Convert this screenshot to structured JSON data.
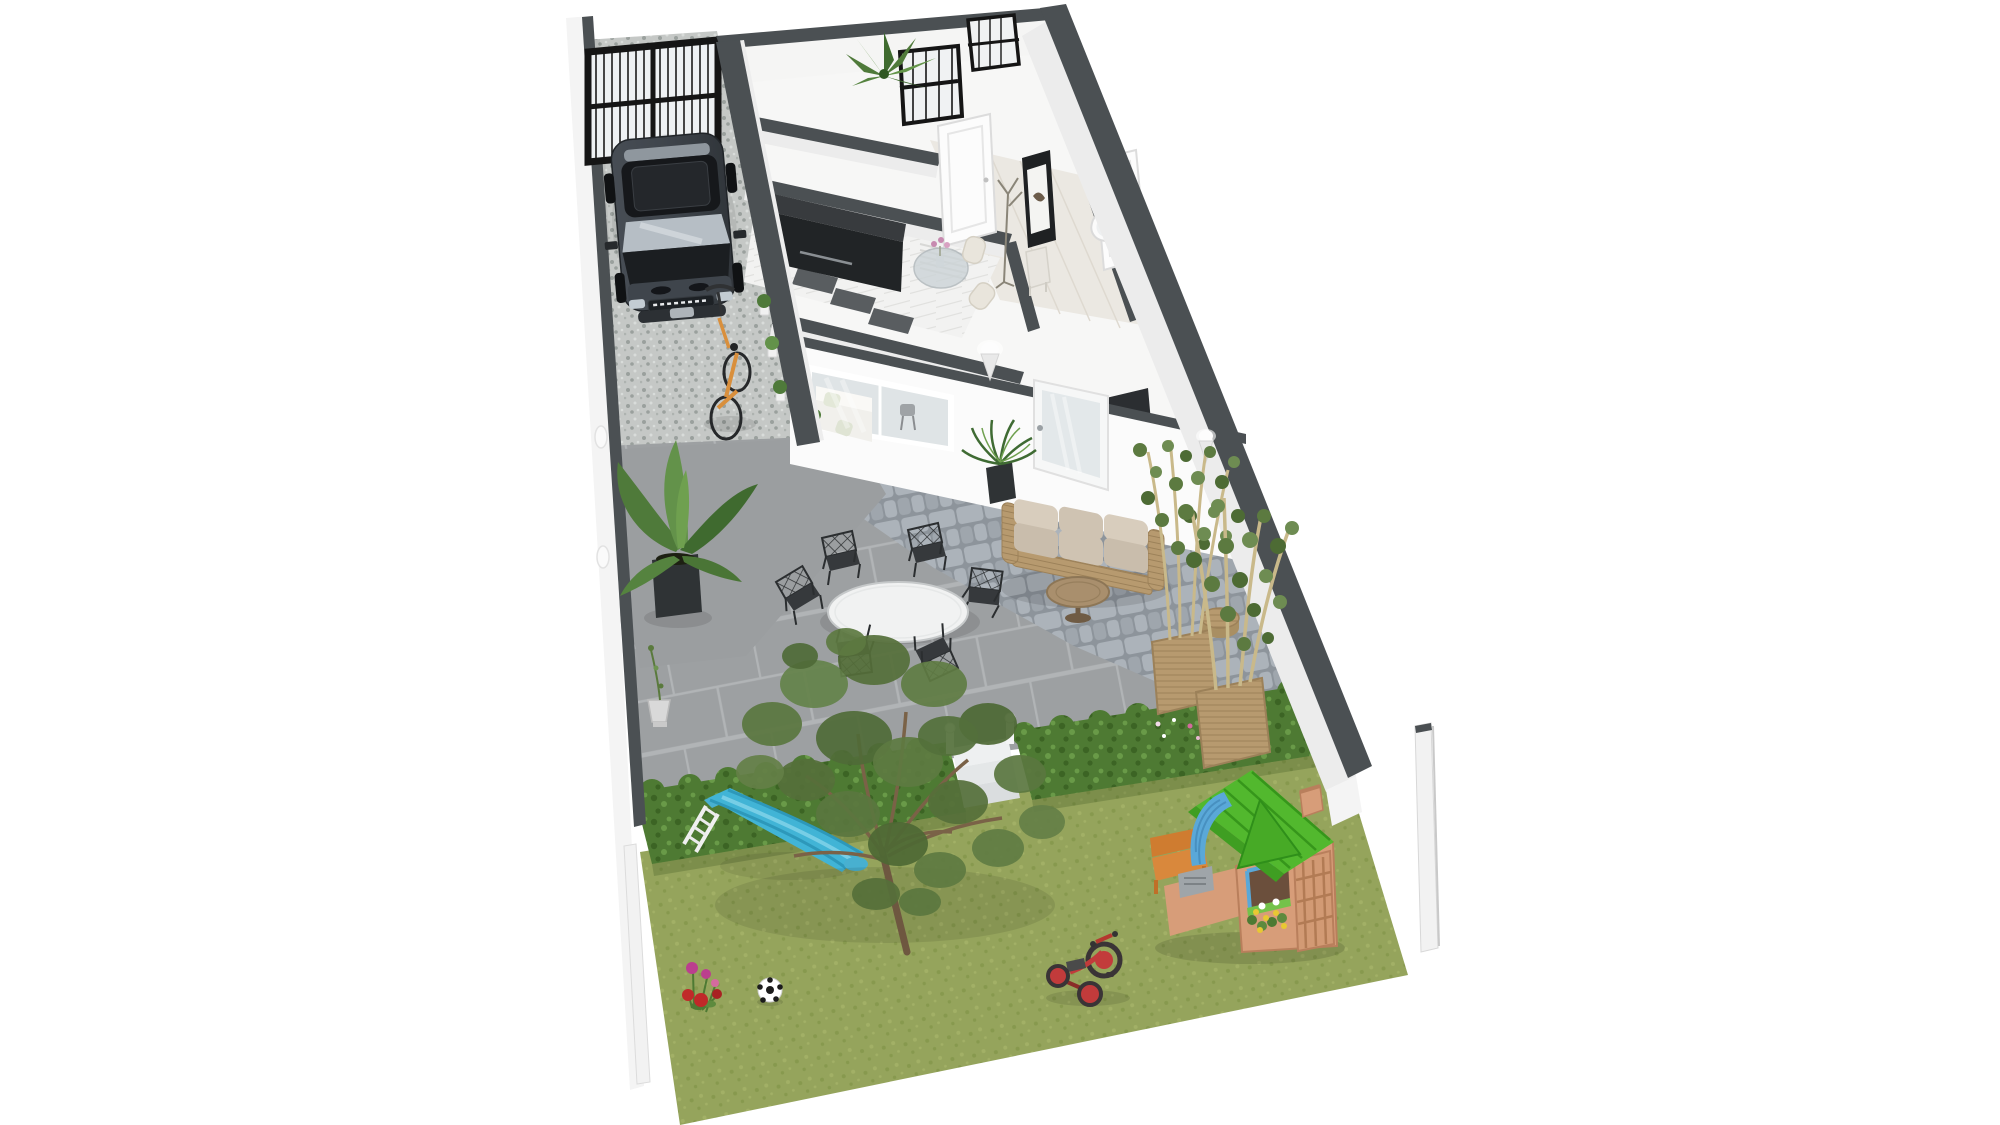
{
  "meta": {
    "image_type": "isometric 3D floor plan rendering",
    "description": "Long narrow residential lot on white background: gravel driveway with SUV and garage gate, single-storey house interior, paved courtyard patio with outdoor furniture, trimmed hedge with steps, back lawn with tree and children's play equipment"
  },
  "colors": {
    "background": "#ffffff",
    "wall_cap": "#4b5053",
    "wall_face": "#f4f4f4",
    "wall_face_shaded": "#ececec",
    "rear_wall": "#fbfbfb",
    "interior_floor": "#f7f7f6",
    "hallway_floor": "#ebe8e2",
    "tile_dark": "#595d60",
    "gate_frame": "#151515",
    "gate_glass": "#eef1f3",
    "gravel_base": "#c5c8c6",
    "gravel_dark": "#9aa09d",
    "gravel_mid": "#aeb3b0",
    "gravel_light": "#d9dcda",
    "concrete": "#9b9ea0",
    "paver_base": "#9da0a2",
    "paver_joint": "#b1b4b6",
    "cobble_joint": "#8d949b",
    "cobble_stone": "#acb3ba",
    "cobble_stone_alt": "#9fa6ad",
    "grass_base": "#95a45c",
    "grass_dark": "#87994e",
    "grass_light": "#a2b066",
    "hedge_base": "#4e7a33",
    "hedge_dark": "#3c6424",
    "hedge_light": "#699a48",
    "steps_white": "#eef0f1",
    "tree_trunk": "#6e5740",
    "foliage_main": "#5a763f",
    "car_body": "#3f454c",
    "car_roof": "#16181b",
    "car_glass": "#b6bec5",
    "kitchen_cabinet_top": "#383b3e",
    "kitchen_cabinet_front": "#212426",
    "marble": "#f2f2f1",
    "door_white": "#fcfcfc",
    "table_top": "#f1f2f2",
    "chair_metal": "#2b2e30",
    "sofa_cushion": "#cfc3b2",
    "sofa_cushion_dark": "#c9bdac",
    "sofa_cushion_light": "#d8cdbd",
    "wicker": "#b79a6f",
    "wicker_line": "#9c8159",
    "wood_table": "#a98f6d",
    "planter_black": "#2f3335",
    "leaf_green": "#4f7a3a",
    "leaf_light": "#6fa04f",
    "bamboo_stem": "#c9b98a",
    "fern_green": "#3f6b33",
    "slide_blue": "#41b4d6",
    "slide_blue_dark": "#2d98ba",
    "ladder_white": "#f0f0f0",
    "playhouse_tan": "#d79d79",
    "playhouse_tan_dark": "#b97f5c",
    "playhouse_roof": "#52b82e",
    "playhouse_roof_dark": "#36961b",
    "playhouse_gable": "#47aa26",
    "playhouse_awning": "#5aa8d8",
    "awning_dark": "#4890c0",
    "bench_orange": "#d9883c",
    "bench_orange_dark": "#cf7c30",
    "trike_red": "#c23b3b",
    "trike_dark": "#3a3436",
    "ball_white": "#ffffff",
    "ball_black": "#1c1c1c",
    "flower_magenta": "#bb3f8e",
    "flower_red": "#c02929",
    "flower_pink": "#d46a9e",
    "flower_yellow": "#e8c832",
    "urn_gray": "#d9d9d9",
    "urn_bronze": "#7a6a4e",
    "post_white": "#f2f2f2",
    "picture_frame": "#1f2123",
    "sconce_white": "#fdfdfd"
  },
  "scene": {
    "style": "isometric 3D architectural render, no visible text",
    "areas": {
      "driveway": {
        "label": "Gravel driveway behind black glass garage gate"
      },
      "house": {
        "label": "House interior",
        "rooms": [
          "entry room",
          "kitchen-diner",
          "hallway",
          "bathroom",
          "living room"
        ]
      },
      "patio": {
        "label": "Paved courtyard patio",
        "surfaces": [
          "smooth concrete",
          "large pavers",
          "cobblestones"
        ]
      },
      "hedge": {
        "label": "Trimmed hedge with step opening to garden"
      },
      "lawn": {
        "label": "Back garden lawn"
      }
    },
    "objects": [
      {
        "id": "garage-gate",
        "label": "Black framed glass garage gate"
      },
      {
        "id": "suv",
        "label": "Dark grey SUV parked facing the gate"
      },
      {
        "id": "bicycle",
        "label": "Bicycle with orange frame on driveway"
      },
      {
        "id": "grid-windows",
        "label": "Black grid windows in street wall"
      },
      {
        "id": "agave-plant",
        "label": "Agave plant on wall top"
      },
      {
        "id": "kitchen-sideboard",
        "label": "Long black gloss sideboard"
      },
      {
        "id": "indoor-dining-set",
        "label": "Round glass table with cream chairs and flower vase"
      },
      {
        "id": "hallway-doors",
        "label": "White panelled interior doors"
      },
      {
        "id": "coat-rack",
        "label": "Coat stand"
      },
      {
        "id": "console-table",
        "label": "Small console table"
      },
      {
        "id": "wall-picture",
        "label": "Dark framed artwork"
      },
      {
        "id": "bathtub",
        "label": "White bathtub"
      },
      {
        "id": "living-room-sofa",
        "label": "White sofa seen through rear sliding window"
      },
      {
        "id": "rear-window",
        "label": "Sliding window to patio"
      },
      {
        "id": "patio-door",
        "label": "Glazed patio door"
      },
      {
        "id": "wall-sconces",
        "label": "Cone wall lights"
      },
      {
        "id": "banana-plant",
        "label": "Banana plant in black cube planter"
      },
      {
        "id": "patio-dining-set",
        "label": "Round white table with six metal lattice chairs"
      },
      {
        "id": "outdoor-sofa",
        "label": "Beige rattan garden sofa"
      },
      {
        "id": "coffee-table",
        "label": "Round wooden coffee table"
      },
      {
        "id": "side-stool",
        "label": "Rattan side stool"
      },
      {
        "id": "bamboo-plants",
        "label": "Potted bamboo screens in woven baskets"
      },
      {
        "id": "fern-pot",
        "label": "Potted fern by patio door"
      },
      {
        "id": "garden-urns",
        "label": "Small urn planters with saplings"
      },
      {
        "id": "hedge-steps",
        "label": "White garden steps through hedge"
      },
      {
        "id": "garden-tree",
        "label": "Large sparse garden tree"
      },
      {
        "id": "slide",
        "label": "Blue children's slide with white ladder"
      },
      {
        "id": "playhouse",
        "label": "Tan kids playhouse with green roof and blue awning"
      },
      {
        "id": "play-bench",
        "label": "Orange toy bench"
      },
      {
        "id": "tricycle",
        "label": "Red tricycle"
      },
      {
        "id": "soccer-ball",
        "label": "Black and white football"
      },
      {
        "id": "garden-flowers",
        "label": "Pink and red flowers on lawn"
      },
      {
        "id": "boundary-post",
        "label": "Free-standing white boundary post"
      }
    ],
    "counts": {
      "patio_chairs": 6,
      "sofa_cushions": 3,
      "bamboo_pots": 2,
      "wall_lights": 4,
      "hedge_flower_dots": 8
    }
  }
}
